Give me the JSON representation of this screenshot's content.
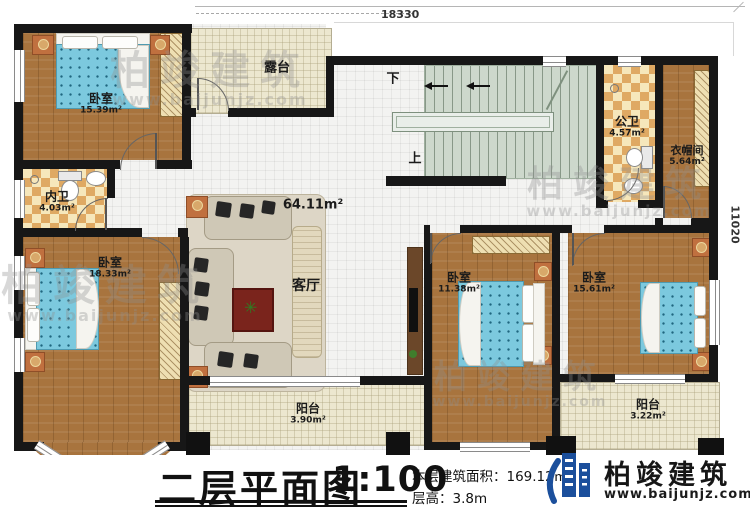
{
  "dimensions": {
    "top": "18330",
    "right": "11020"
  },
  "rooms": [
    {
      "id": "bedroom-top-left",
      "name": "卧室",
      "area": "15.39m²"
    },
    {
      "id": "inner-bath",
      "name": "内卫",
      "area": "4.03m²"
    },
    {
      "id": "bedroom-bottom-left",
      "name": "卧室",
      "area": "18.33m²"
    },
    {
      "id": "terrace",
      "name": "露台",
      "area": ""
    },
    {
      "id": "living-room",
      "name": "客厅",
      "area": "64.11m²"
    },
    {
      "id": "public-bath",
      "name": "公卫",
      "area": "4.57m²"
    },
    {
      "id": "cloakroom",
      "name": "衣帽间",
      "area": "5.64m²"
    },
    {
      "id": "bedroom-bottom-mid",
      "name": "卧室",
      "area": "11.38m²"
    },
    {
      "id": "bedroom-bottom-right",
      "name": "卧室",
      "area": "15.61m²"
    },
    {
      "id": "balcony-left",
      "name": "阳台",
      "area": "3.90m²"
    },
    {
      "id": "balcony-right",
      "name": "阳台",
      "area": "3.22m²"
    }
  ],
  "stairs": {
    "down_label": "下",
    "up_label": "上"
  },
  "titleblock": {
    "title": "二层平面图",
    "scale": "1:100",
    "area_line": "本层建筑面积：169.12㎡",
    "height_line": "层高：3.8m"
  },
  "brand": {
    "name": "柏竣建筑",
    "url": "www.baijunjz.com"
  },
  "watermark": {
    "name": "柏竣建筑",
    "url": "www.baijunjz.com"
  }
}
